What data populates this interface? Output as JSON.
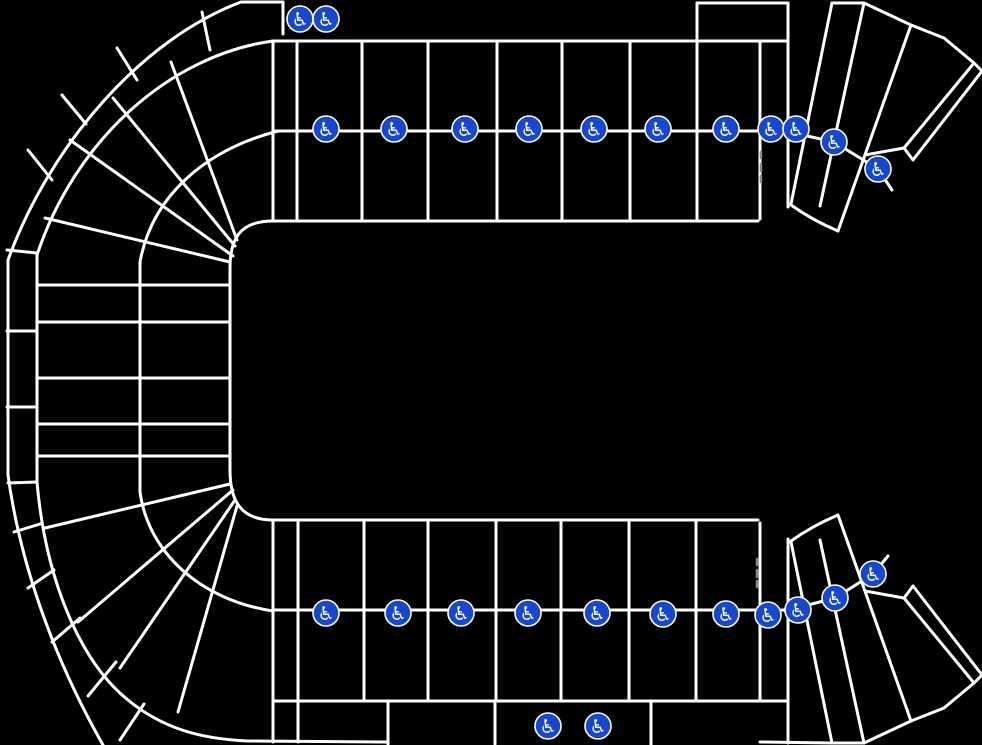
{
  "map": {
    "name": "arena-seating-map",
    "canvas": {
      "width": 982,
      "height": 745
    },
    "colors": {
      "background": "#000000",
      "section_line": "#ffffff",
      "aisle_dash": "#8a8a8a",
      "icon_background": "#1747cd",
      "icon_ring": "#ffffff",
      "icon_symbol": "#ffffff"
    },
    "accessible_seating_icon": {
      "semantic": "wheelchair-accessible-seating",
      "glyph": "♿",
      "radius": 13,
      "glyph_size": 19,
      "line_width": 3
    },
    "section_outlines": [
      {
        "name": "bowl-outer-boundary",
        "d": "M283 2 H241 C145 38 52 140 8 260 L8 475 C20 562 52 655 103 745"
      },
      {
        "name": "bowl-outer-top-cut",
        "d": "M283 2 V34"
      },
      {
        "name": "bowl-ring1-boundary",
        "d": "M273 41 C170 55 75 140 37 255 L37 482 C45 575 78 660 128 700 C162 728 200 739 248 741 L388 742"
      },
      {
        "name": "bowl-ring1-bottom-right",
        "d": "M760 742 L832 743 H864"
      },
      {
        "name": "bowl-ring2-boundary",
        "d": "M278 131 C205 150 152 196 140 262 L140 492 C148 552 200 600 273 611"
      },
      {
        "name": "floor-left-boundary",
        "d": "M273 221 C238 221 230 241 230 268 L230 470 C230 497 238 520 273 520"
      },
      {
        "name": "outer-ring-divider",
        "d": "M202 12 L210 50"
      },
      {
        "name": "outer-ring-divider",
        "d": "M117 48 L137 80"
      },
      {
        "name": "outer-ring-divider",
        "d": "M62 95 L86 124"
      },
      {
        "name": "outer-ring-divider",
        "d": "M28 150 L52 180"
      },
      {
        "name": "outer-ring-divider",
        "d": "M7 250 L37 253"
      },
      {
        "name": "outer-ring-divider",
        "d": "M7 331 L37 331"
      },
      {
        "name": "outer-ring-divider",
        "d": "M7 407 L37 407"
      },
      {
        "name": "outer-ring-divider",
        "d": "M8 483 L37 482"
      },
      {
        "name": "outer-ring-divider",
        "d": "M14 532 L40 524"
      },
      {
        "name": "outer-ring-divider",
        "d": "M28 588 L54 570"
      },
      {
        "name": "outer-ring-divider",
        "d": "M52 642 L80 618"
      },
      {
        "name": "outer-ring-divider",
        "d": "M88 696 L116 662"
      },
      {
        "name": "outer-ring-divider",
        "d": "M120 740 L144 704"
      },
      {
        "name": "bowl-spoke",
        "d": "M171 62 L237 240"
      },
      {
        "name": "bowl-spoke",
        "d": "M113 98 L235 246"
      },
      {
        "name": "bowl-spoke",
        "d": "M70 140 L233 256"
      },
      {
        "name": "bowl-spoke",
        "d": "M45 218 L230 262"
      },
      {
        "name": "bowl-row-divider",
        "d": "M37 285 H230"
      },
      {
        "name": "bowl-row-divider",
        "d": "M37 322 H230"
      },
      {
        "name": "bowl-row-divider",
        "d": "M37 378 H230"
      },
      {
        "name": "bowl-row-divider",
        "d": "M37 424 H230"
      },
      {
        "name": "bowl-row-divider",
        "d": "M37 456 H230"
      },
      {
        "name": "bowl-spoke",
        "d": "M178 712 L237 506"
      },
      {
        "name": "bowl-spoke",
        "d": "M120 668 L235 500"
      },
      {
        "name": "bowl-spoke",
        "d": "M78 622 L233 490"
      },
      {
        "name": "bowl-spoke",
        "d": "M45 528 L230 484"
      },
      {
        "name": "top-band-top-edge",
        "d": "M273 41 H788"
      },
      {
        "name": "top-band-mid-line",
        "d": "M273 131 H785"
      },
      {
        "name": "top-band-bottom-edge",
        "d": "M273 221 H758"
      },
      {
        "name": "top-notch-top-edge",
        "d": "M697 3 H788"
      },
      {
        "name": "top-band-divider",
        "d": "M273 41 V221"
      },
      {
        "name": "top-band-divider",
        "d": "M297 41 V221"
      },
      {
        "name": "top-band-divider",
        "d": "M362 41 V221"
      },
      {
        "name": "top-band-divider",
        "d": "M428 41 V221"
      },
      {
        "name": "top-band-divider",
        "d": "M497 41 V221"
      },
      {
        "name": "top-band-divider",
        "d": "M562 41 V221"
      },
      {
        "name": "top-band-divider",
        "d": "M630 41 V221"
      },
      {
        "name": "top-band-divider",
        "d": "M697 3 V221"
      },
      {
        "name": "top-band-divider",
        "d": "M760 41 V219"
      },
      {
        "name": "top-band-divider",
        "d": "M788 3 V207"
      },
      {
        "name": "top-fan-radial",
        "d": "M791 204 L832 3"
      },
      {
        "name": "top-fan-top-edge",
        "d": "M832 3 H864"
      },
      {
        "name": "top-fan-radial",
        "d": "M820 206 L864 3"
      },
      {
        "name": "top-fan-radial",
        "d": "M838 231 L911 25"
      },
      {
        "name": "top-fan-outer-edge",
        "d": "M864 3 L911 25 L944 38 L974 63"
      },
      {
        "name": "top-fan-inner-edge",
        "d": "M904 148 L865 155"
      },
      {
        "name": "top-fan-corner-section",
        "d": "M974 63 L982 71 L913 160 L904 148 Z"
      },
      {
        "name": "top-fan-apex-arc",
        "d": "M791 205 Q812 220 838 231"
      },
      {
        "name": "top-fan-aisle-chain",
        "d": "M785 131 L834 142 L878 169 L892 190"
      },
      {
        "name": "bottom-band-top-edge",
        "d": "M273 520 H758"
      },
      {
        "name": "bottom-band-mid-line",
        "d": "M273 610 H785"
      },
      {
        "name": "bottom-band-bottom-edge",
        "d": "M273 701 H788"
      },
      {
        "name": "bottom-band-divider",
        "d": "M273 520 V742"
      },
      {
        "name": "bottom-band-divider",
        "d": "M298 520 V742"
      },
      {
        "name": "bottom-band-divider",
        "d": "M364 520 V701"
      },
      {
        "name": "bottom-band-divider",
        "d": "M428 520 V701"
      },
      {
        "name": "bottom-band-divider",
        "d": "M496 520 V701"
      },
      {
        "name": "bottom-band-divider",
        "d": "M561 520 V701"
      },
      {
        "name": "bottom-band-divider",
        "d": "M629 520 V701"
      },
      {
        "name": "bottom-band-divider",
        "d": "M696 520 V701"
      },
      {
        "name": "bottom-band-divider",
        "d": "M760 523 V701"
      },
      {
        "name": "bottom-band-divider",
        "d": "M788 539 V743"
      },
      {
        "name": "bottom-subrow-divider",
        "d": "M388 701 V744"
      },
      {
        "name": "bottom-subrow-divider",
        "d": "M495 701 V744"
      },
      {
        "name": "bottom-subrow-divider",
        "d": "M651 701 V745"
      },
      {
        "name": "bottom-fan-radial",
        "d": "M791 542 L832 743"
      },
      {
        "name": "bottom-fan-radial",
        "d": "M820 540 L864 743"
      },
      {
        "name": "bottom-fan-radial",
        "d": "M838 515 L911 721"
      },
      {
        "name": "bottom-fan-outer-edge",
        "d": "M864 743 L911 721 L944 708 L974 683"
      },
      {
        "name": "bottom-fan-inner-edge",
        "d": "M904 598 L865 591"
      },
      {
        "name": "bottom-fan-corner-section",
        "d": "M974 683 L982 675 L913 586 L904 598 Z"
      },
      {
        "name": "bottom-fan-apex-arc",
        "d": "M791 541 Q812 526 838 515"
      },
      {
        "name": "bottom-fan-aisle-chain",
        "d": "M785 611 L835 598 L873 574 L888 556"
      }
    ],
    "aisle_dashes": [
      {
        "name": "aisle-dash",
        "d": "M761 152 V158"
      },
      {
        "name": "aisle-dash",
        "d": "M761 164 V171"
      },
      {
        "name": "aisle-dash",
        "d": "M761 176 V182"
      },
      {
        "name": "aisle-dash",
        "d": "M757 559 V565"
      },
      {
        "name": "aisle-dash",
        "d": "M757 570 V577"
      },
      {
        "name": "aisle-dash",
        "d": "M757 581 V587"
      }
    ],
    "accessible_locations": [
      {
        "x": 300,
        "y": 19
      },
      {
        "x": 326,
        "y": 19
      },
      {
        "x": 326,
        "y": 129
      },
      {
        "x": 394,
        "y": 129
      },
      {
        "x": 465,
        "y": 129
      },
      {
        "x": 529,
        "y": 129
      },
      {
        "x": 594,
        "y": 129
      },
      {
        "x": 658,
        "y": 129
      },
      {
        "x": 726,
        "y": 129
      },
      {
        "x": 771,
        "y": 129
      },
      {
        "x": 796,
        "y": 129
      },
      {
        "x": 834,
        "y": 142
      },
      {
        "x": 878,
        "y": 169
      },
      {
        "x": 326,
        "y": 613
      },
      {
        "x": 398,
        "y": 613
      },
      {
        "x": 461,
        "y": 613
      },
      {
        "x": 528,
        "y": 613
      },
      {
        "x": 597,
        "y": 613
      },
      {
        "x": 663,
        "y": 614
      },
      {
        "x": 726,
        "y": 614
      },
      {
        "x": 768,
        "y": 615
      },
      {
        "x": 798,
        "y": 610
      },
      {
        "x": 835,
        "y": 598
      },
      {
        "x": 873,
        "y": 574
      },
      {
        "x": 548,
        "y": 726
      },
      {
        "x": 598,
        "y": 726
      }
    ]
  }
}
